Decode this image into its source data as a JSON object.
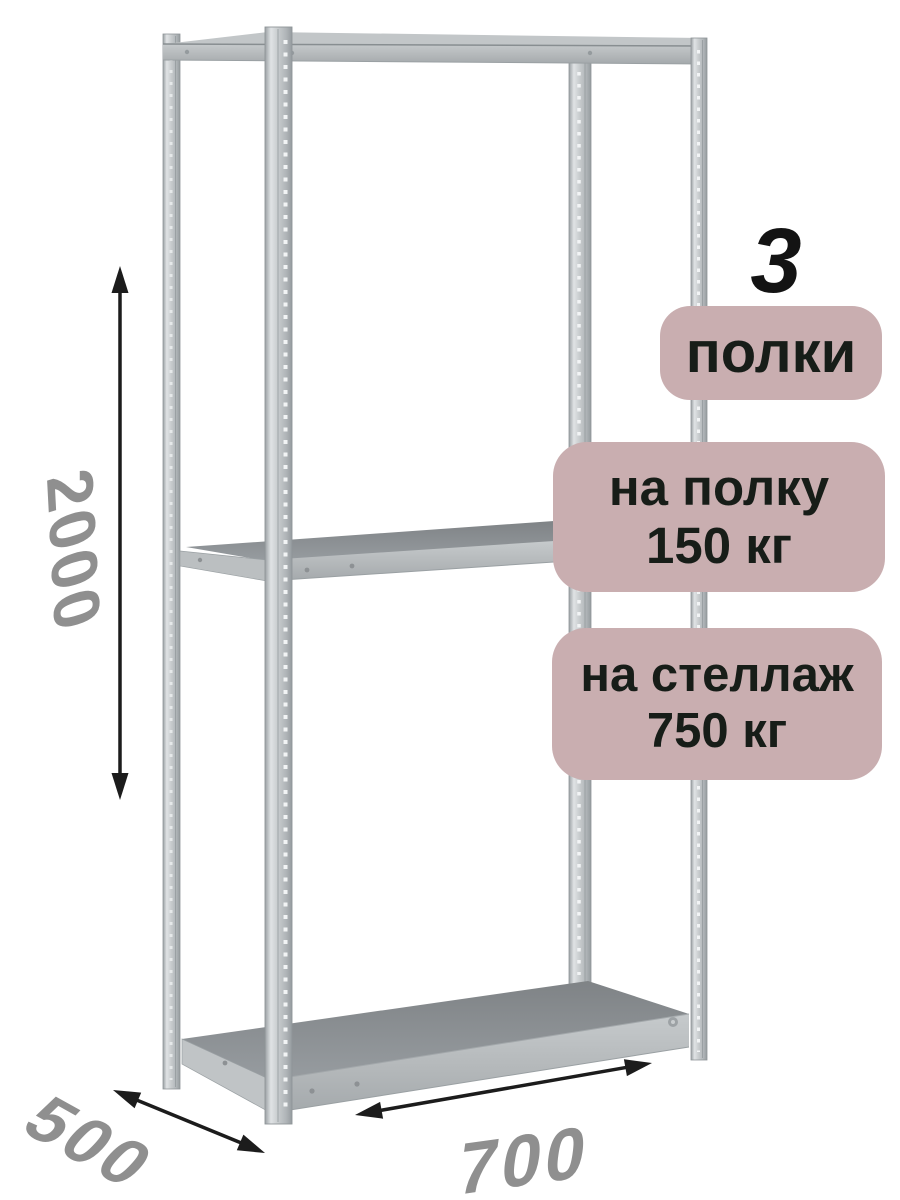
{
  "scene": {
    "description": "3D render of a grey boltless metal shelving rack with three shelves and black dimension arrows on white background"
  },
  "badges": {
    "count_number": "3",
    "count_label": "полки",
    "per_shelf_line1": "на полку",
    "per_shelf_line2": "150 кг",
    "per_rack_line1": "на стеллаж",
    "per_rack_line2": "750 кг"
  },
  "dimensions": {
    "height_mm": "2000",
    "depth_mm": "500",
    "width_mm": "700"
  },
  "colors": {
    "background": "#ffffff",
    "badge_bg": "#c9aeb0",
    "badge_text": "#171d18",
    "number_text": "#131313",
    "dimension_text": "#8f8f8f",
    "arrow": "#1c1c1c",
    "metal_post_light": "#d8dcde",
    "metal_post_mid": "#bcc1c3",
    "metal_beam": "#b6babc",
    "shelf_surface_dark": "#8c9093"
  }
}
